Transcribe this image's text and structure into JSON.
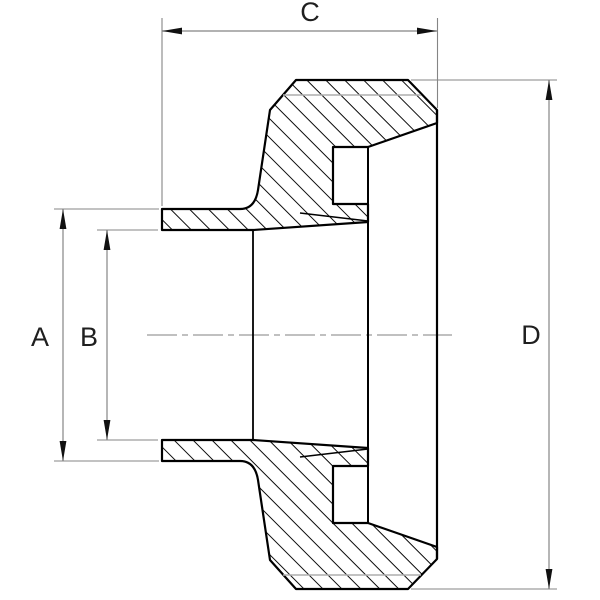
{
  "drawing": {
    "kind": "pipe-fitting cross-section",
    "labels": {
      "a": "A",
      "b": "B",
      "c": "C",
      "d": "D"
    }
  },
  "colors": {
    "outline": "#000000",
    "hatch": "#000000",
    "dimension_lines": "#858585",
    "arrowheads": "#111111",
    "centerline": "#9b9b9b",
    "thread_line": "#aeaeae",
    "label_text": "#1f1f1f",
    "background": "#ffffff"
  }
}
